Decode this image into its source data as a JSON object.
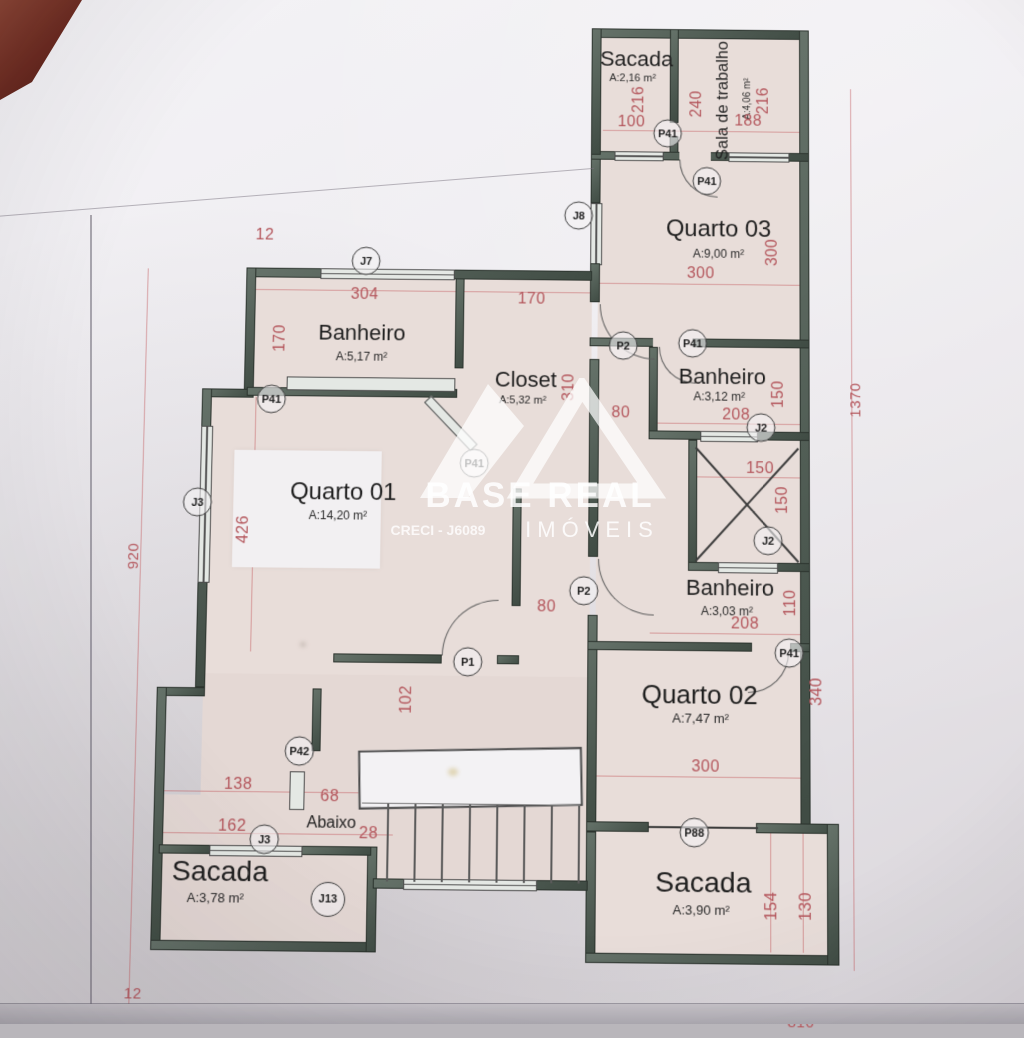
{
  "watermark": {
    "brand": "BASE REAL",
    "sub": "IMÓVEIS",
    "creci": "CRECI - J6089"
  },
  "rooms": [
    {
      "name": "Sacada",
      "area": "A:2,16 m²"
    },
    {
      "name": "Sala de trabalho",
      "area": "A:4,06 m²"
    },
    {
      "name": "Quarto 03",
      "area": "A:9,00 m²"
    },
    {
      "name": "Banheiro",
      "area": "A:5,17 m²"
    },
    {
      "name": "Closet",
      "area": "A:5,32 m²"
    },
    {
      "name": "Banheiro",
      "area": "A:3,12 m²"
    },
    {
      "name": "Quarto 01",
      "area": "A:14,20 m²"
    },
    {
      "name": "Banheiro",
      "area": "A:3,03 m²"
    },
    {
      "name": "Quarto 02",
      "area": "A:7,47 m²"
    },
    {
      "name": "Sacada",
      "area": "A:3,78 m²"
    },
    {
      "name": "Sacada",
      "area": "A:3,90 m²"
    }
  ],
  "stairs": {
    "label": "Abaixo"
  },
  "dims": [
    "12",
    "304",
    "170",
    "170",
    "216",
    "100",
    "240",
    "188",
    "216",
    "300",
    "300",
    "208",
    "150",
    "150",
    "150",
    "208",
    "110",
    "80",
    "310",
    "80",
    "102",
    "426",
    "920",
    "1370",
    "340",
    "300",
    "138",
    "68",
    "162",
    "28",
    "154",
    "130",
    "12",
    "810"
  ],
  "tags": [
    "J7",
    "J8",
    "P41",
    "P41",
    "P41",
    "P2",
    "J2",
    "J2",
    "P2",
    "P41",
    "P41",
    "P1",
    "P41",
    "P42",
    "J3",
    "J3",
    "J13",
    "P88"
  ]
}
